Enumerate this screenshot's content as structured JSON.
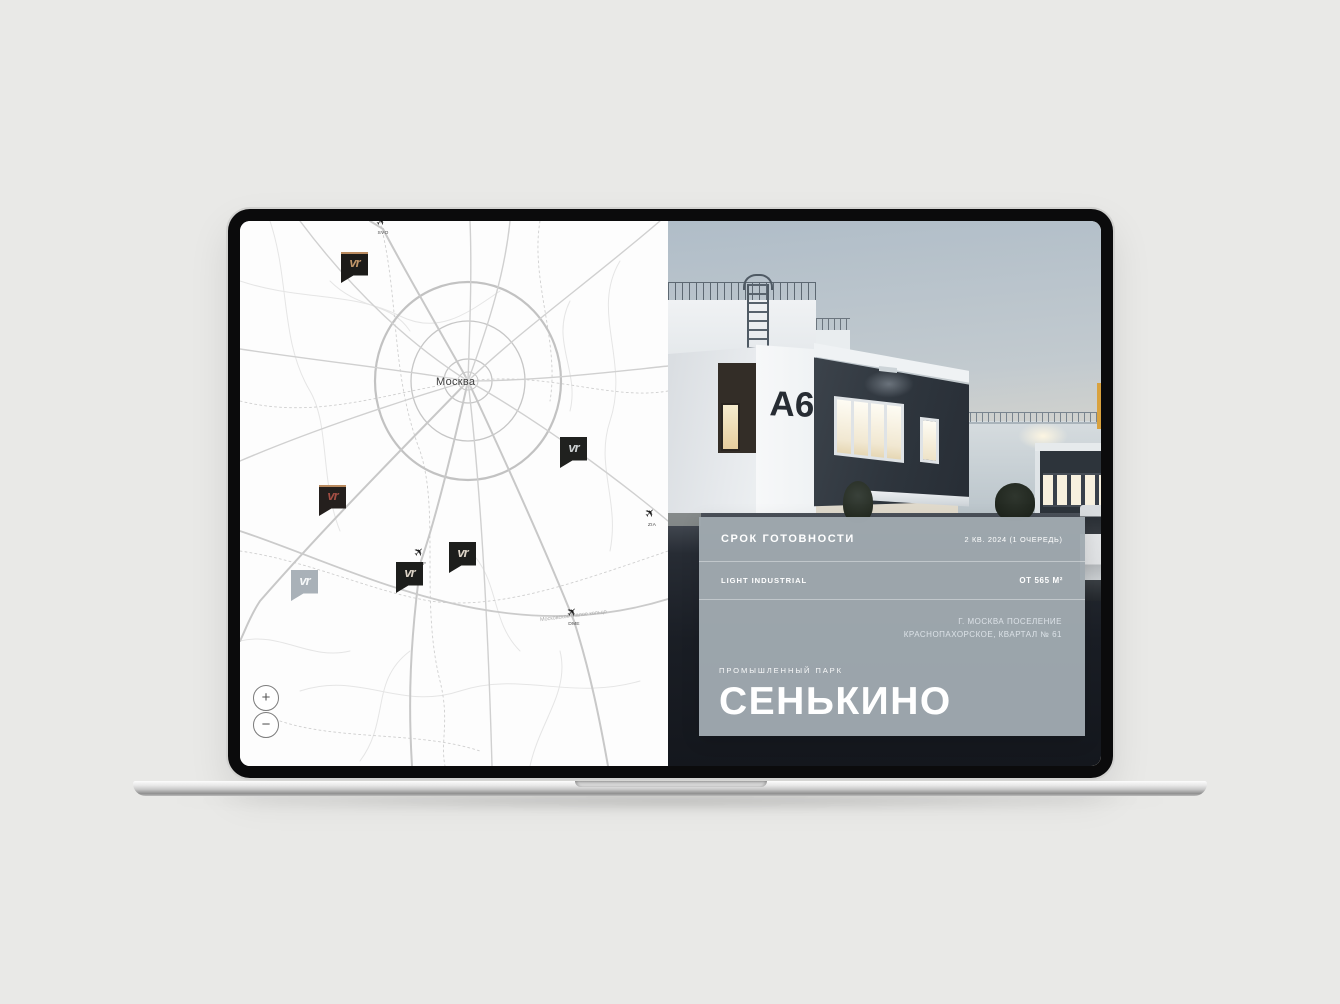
{
  "page": {
    "background": "#e9e9e7"
  },
  "map": {
    "city_label": "Москва",
    "road_label": "Московское Малое кольцо",
    "zoom_in_label": "+",
    "zoom_out_label": "−",
    "airports": [
      {
        "code": "SVO",
        "x": 143,
        "y": 6
      },
      {
        "code": "OSF",
        "x": 181,
        "y": 337
      },
      {
        "code": "DME",
        "x": 334,
        "y": 397
      },
      {
        "code": "ZIA",
        "x": 412,
        "y": 298
      }
    ],
    "markers": [
      {
        "id": "north",
        "x": 101,
        "y": 31,
        "bg": "#1c1b19",
        "logo_color": "#bf9468",
        "top_line": "#b98a5f",
        "logo_text": "vr"
      },
      {
        "id": "east",
        "x": 320,
        "y": 216,
        "bg": "#20211f",
        "logo_color": "#ccd0d2",
        "top_line": "",
        "logo_text": "vr"
      },
      {
        "id": "southwest",
        "x": 79,
        "y": 264,
        "bg": "#241f1d",
        "logo_color": "#a34e44",
        "top_line": "#b98a5f",
        "logo_text": "vr"
      },
      {
        "id": "far-south",
        "x": 51,
        "y": 349,
        "bg": "#a9b1b8",
        "logo_color": "#f5f7f8",
        "top_line": "",
        "logo_text": "vr"
      },
      {
        "id": "south-osf",
        "x": 156,
        "y": 341,
        "bg": "#1d1e1c",
        "logo_color": "#dcd3c6",
        "top_line": "",
        "logo_text": "vr"
      },
      {
        "id": "south-mid",
        "x": 209,
        "y": 321,
        "bg": "#1d1e1c",
        "logo_color": "#dcd3c6",
        "top_line": "",
        "logo_text": "vr"
      }
    ]
  },
  "photo": {
    "building_label": "А6"
  },
  "panel": {
    "bg": "rgba(160,169,175,0.97)",
    "row1_label": "СРОК ГОТОВНОСТИ",
    "row1_value": "2 КВ. 2024 (1 ОЧЕРЕДЬ)",
    "row2_label": "LIGHT INDUSTRIAL",
    "row2_value": "ОТ 565 М²",
    "address_line1": "Г. МОСКВА ПОСЕЛЕНИЕ",
    "address_line2": "КРАСНОПАХОРСКОЕ, КВАРТАЛ № 61",
    "park_type": "ПРОМЫШЛЕННЫЙ ПАРК",
    "park_name": "СЕНЬКИНО"
  }
}
